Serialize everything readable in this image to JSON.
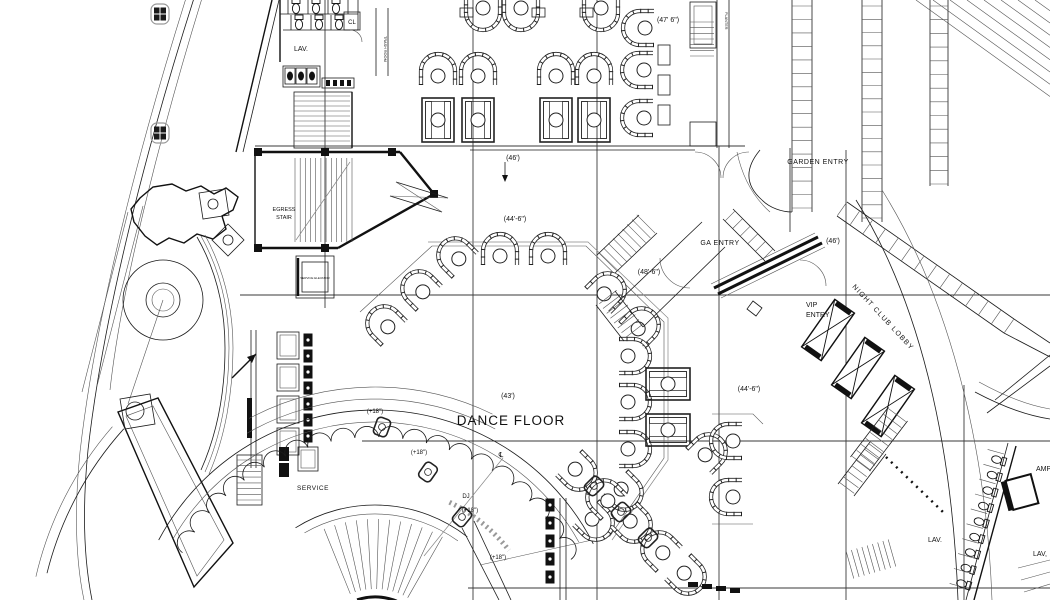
{
  "drawing_title": "Night Club Floor Plan",
  "labels": {
    "dance_floor": "DANCE FLOOR",
    "dj": "DJ",
    "service": "SERVICE",
    "service_elevator": "SERVICE ELEVATOR",
    "egress_line1": "EGRESS",
    "egress_line2": "STAIR",
    "lav_restroom": "LAV.",
    "closet": "CL",
    "trash_room": "TRASH ROOM",
    "planter": "PLANTER",
    "garden_entry": "GARDEN   ENTRY",
    "ga_entry": "GA  ENTRY",
    "vip_line1": "VIP",
    "vip_line2": "ENTRY",
    "night_club_lobby": "NIGHT CLUB LOBBY",
    "lav_a": "LAV.",
    "lav_b": "LAV,",
    "amp": "AMP",
    "centerline_symbol": "℄"
  },
  "dimensions": {
    "bay_47_6": "(47' 6\")",
    "bay_46_top": "(46')",
    "bay_44_6_top": "(44'-6\")",
    "bay_43": "(43')",
    "bay_48_6": "(48'-6\")",
    "bay_46_right": "(46')",
    "bay_44_6_right": "(44'-6\")",
    "plus18_a": "(+18\")",
    "plus18_b": "(+18\")",
    "plus18_c": "(+18\")",
    "plus18_d": "(+18\")"
  }
}
